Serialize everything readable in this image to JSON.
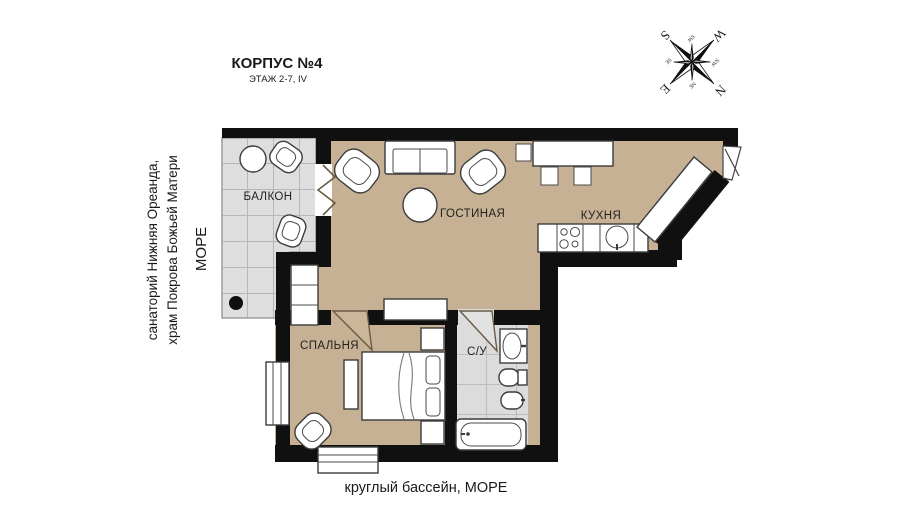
{
  "header": {
    "title": "КОРПУС №4",
    "subtitle": "ЭТАЖ 2-7, IV"
  },
  "side_annotations": {
    "landmarks_line1": "санаторий Нижняя Ореанда,",
    "landmarks_line2": "храм Покрова Божьей Матери",
    "sea_left": "МОРЕ",
    "bottom": "круглый бассейн, МОРЕ"
  },
  "rooms": {
    "balcony": "БАЛКОН",
    "living_room": "ГОСТИНАЯ",
    "kitchen": "КУХНЯ",
    "bedroom": "СПАЛЬНЯ",
    "bathroom": "С/У"
  },
  "compass": {
    "north": "N",
    "east": "E",
    "south": "S",
    "west": "W",
    "northeast": "NE",
    "southeast": "SE",
    "southwest": "SW",
    "northwest": "NW"
  },
  "colors": {
    "walls": "#111111",
    "apartment_floor": "#c7b194",
    "balcony_tiles": "#dedede",
    "bathroom_tiles": "#dcdcdc",
    "background": "#ffffff"
  }
}
